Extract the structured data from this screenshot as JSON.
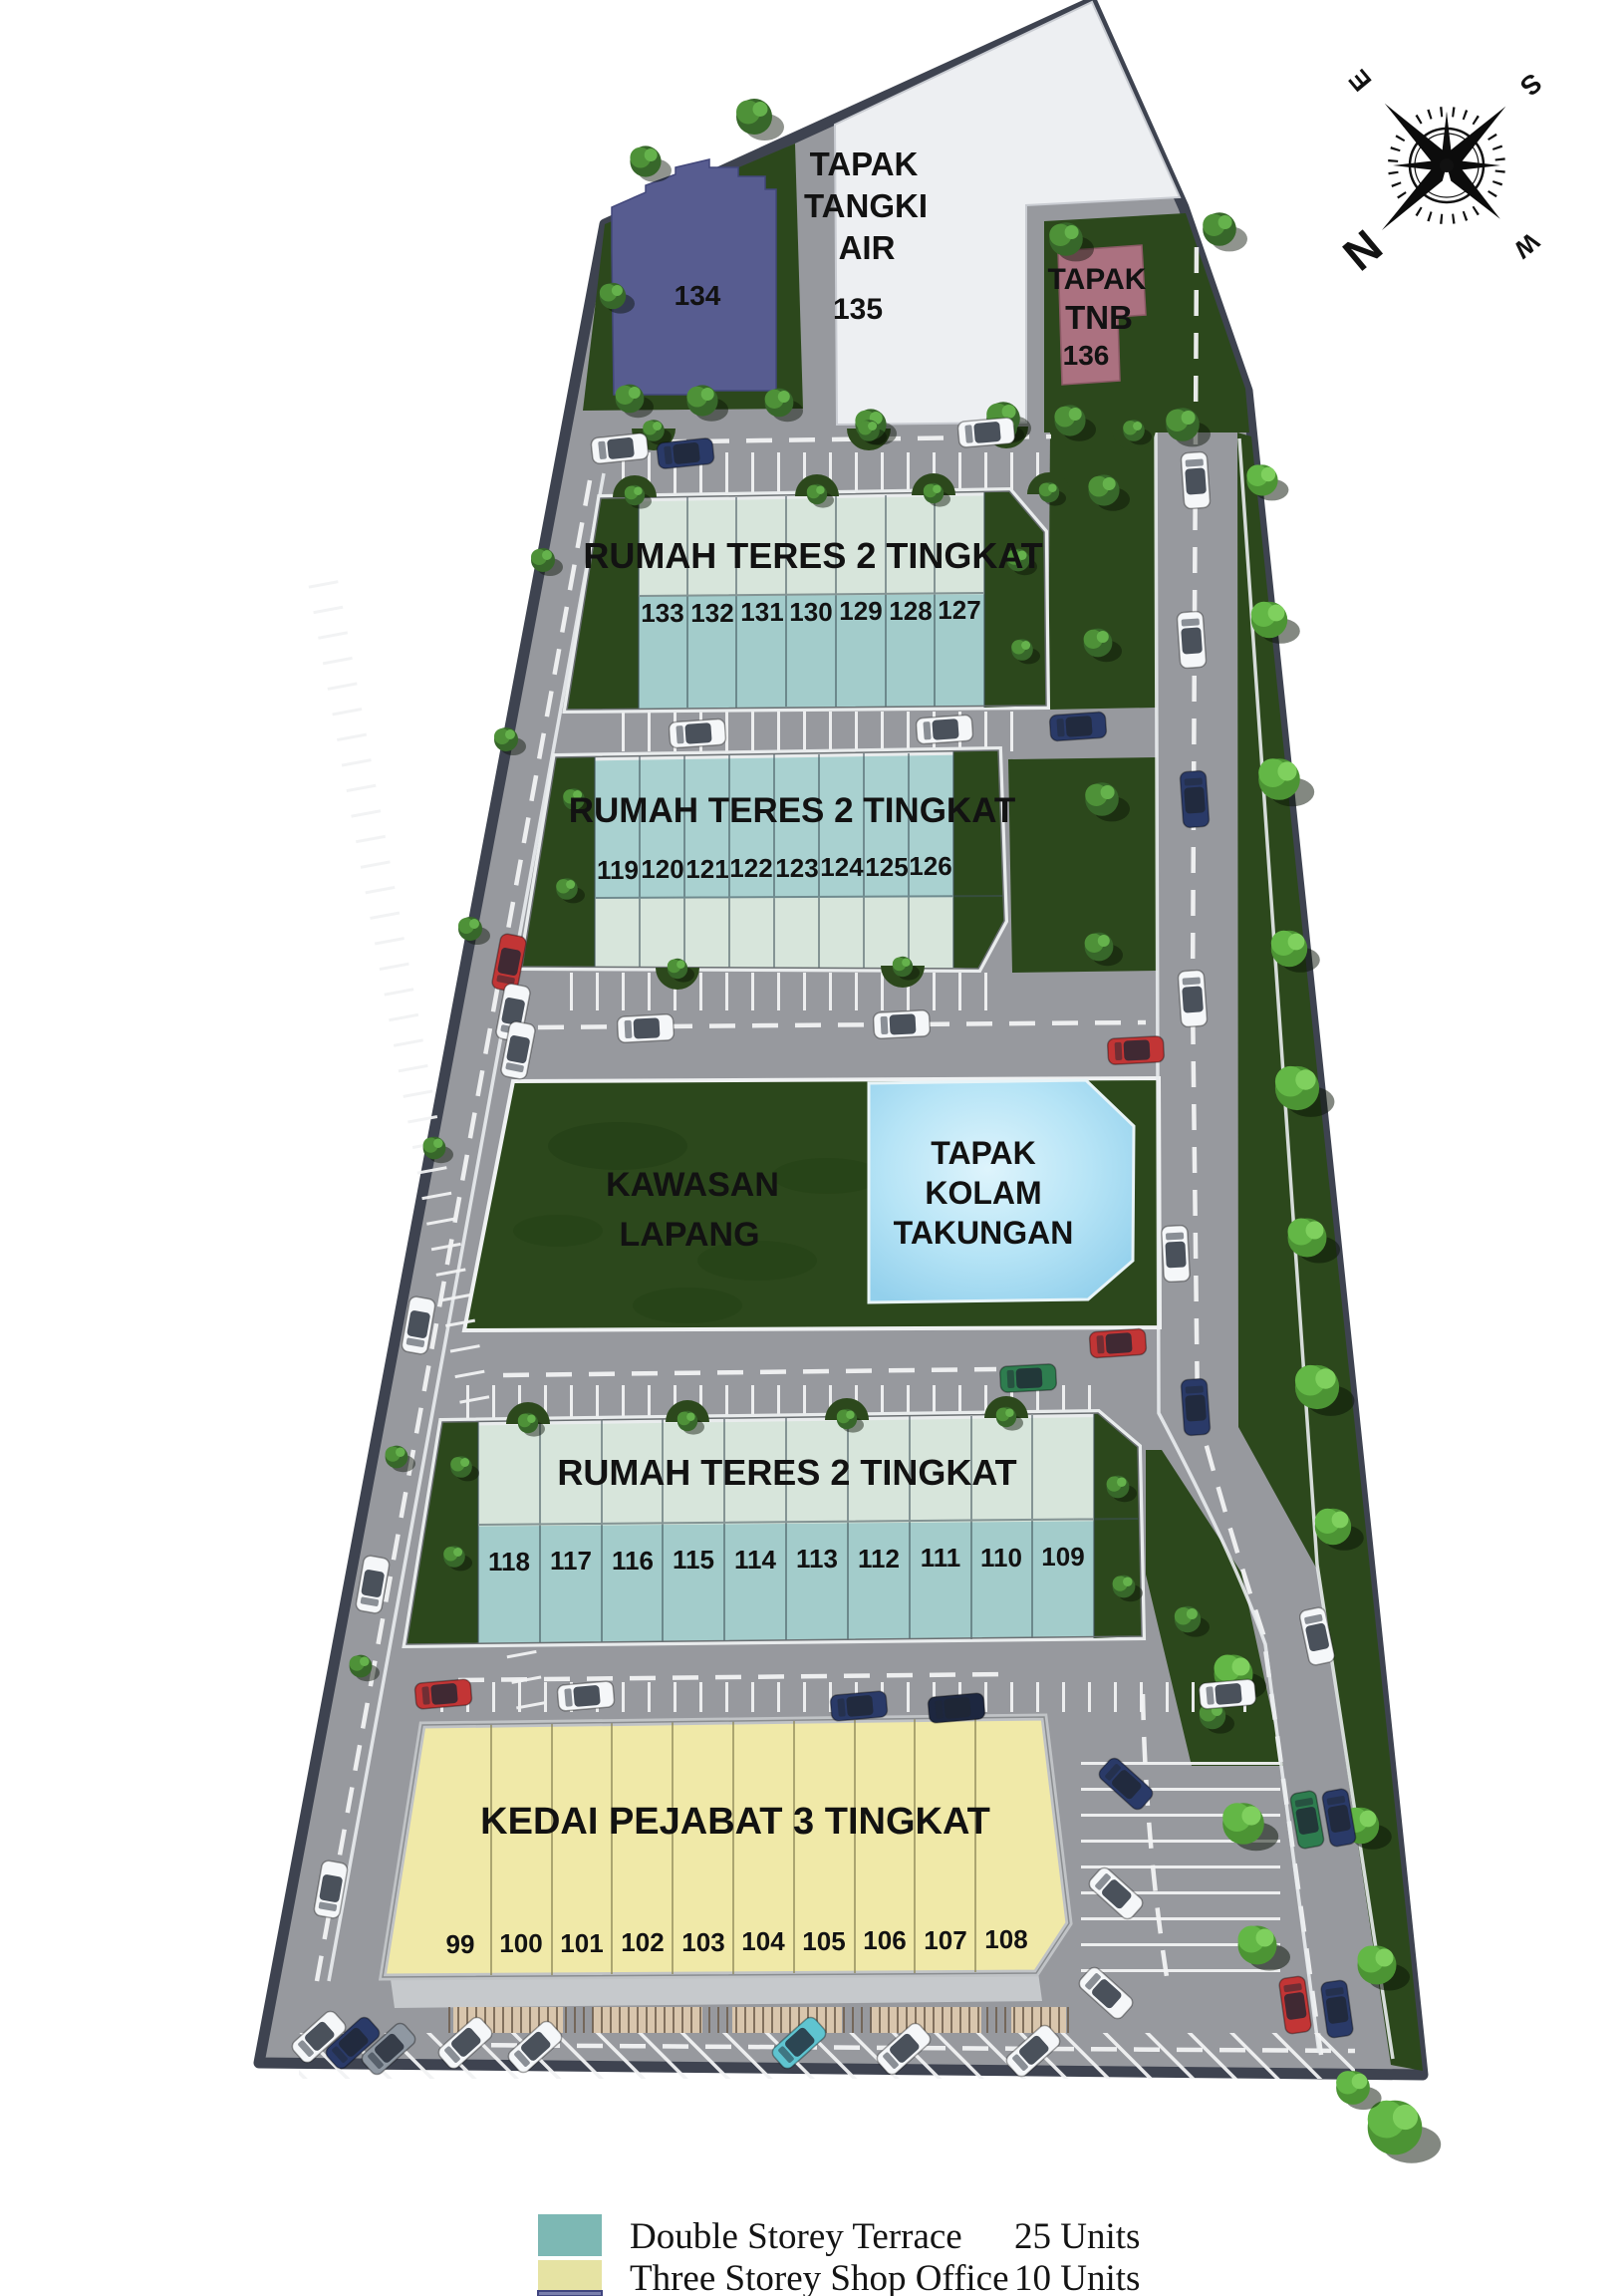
{
  "palette": {
    "road": "#97999e",
    "boundary": "#3e4350",
    "green": "#2c481c",
    "teal": "#a3cccb",
    "mint": "#d7e5db",
    "yellow": "#f0e9a8",
    "pond": "#a8dbf2",
    "lot134": "#575c90",
    "tnb": "#ab7180",
    "tank": "#edeff2"
  },
  "compass": {
    "n": "N",
    "s": "S",
    "e": "E",
    "w": "W"
  },
  "top_areas": {
    "lot134": {
      "num": "134"
    },
    "water_tank": {
      "line1": "TAPAK",
      "line2": "TANGKI",
      "line3": "AIR",
      "num": "135"
    },
    "tnb": {
      "line1": "TAPAK",
      "line2": "TNB",
      "num": "136"
    }
  },
  "open_area": {
    "line1": "KAWASAN",
    "line2": "LAPANG"
  },
  "retention_pond": {
    "line1": "TAPAK",
    "line2": "KOLAM",
    "line3": "TAKUNGAN"
  },
  "blocks": [
    {
      "id": "terrace-row-1",
      "title": "RUMAH TERES 2 TINGKAT",
      "units": [
        "133",
        "132",
        "131",
        "130",
        "129",
        "128",
        "127"
      ]
    },
    {
      "id": "terrace-row-2",
      "title": "RUMAH TERES 2 TINGKAT",
      "units": [
        "119",
        "120",
        "121",
        "122",
        "123",
        "124",
        "125",
        "126"
      ]
    },
    {
      "id": "terrace-row-3",
      "title": "RUMAH TERES 2 TINGKAT",
      "units": [
        "118",
        "117",
        "116",
        "115",
        "114",
        "113",
        "112",
        "111",
        "110",
        "109"
      ]
    },
    {
      "id": "shop-office-row",
      "title": "KEDAI PEJABAT 3 TINGKAT",
      "units": [
        "99",
        "100",
        "101",
        "102",
        "103",
        "104",
        "105",
        "106",
        "107",
        "108"
      ]
    }
  ],
  "legend": {
    "items": [
      {
        "label": "Double Storey Terrace",
        "count": "25 Units",
        "color": "#7db8b4"
      },
      {
        "label": "Three Storey Shop Office",
        "count": "10 Units",
        "color": "#e6e3a3"
      }
    ]
  }
}
